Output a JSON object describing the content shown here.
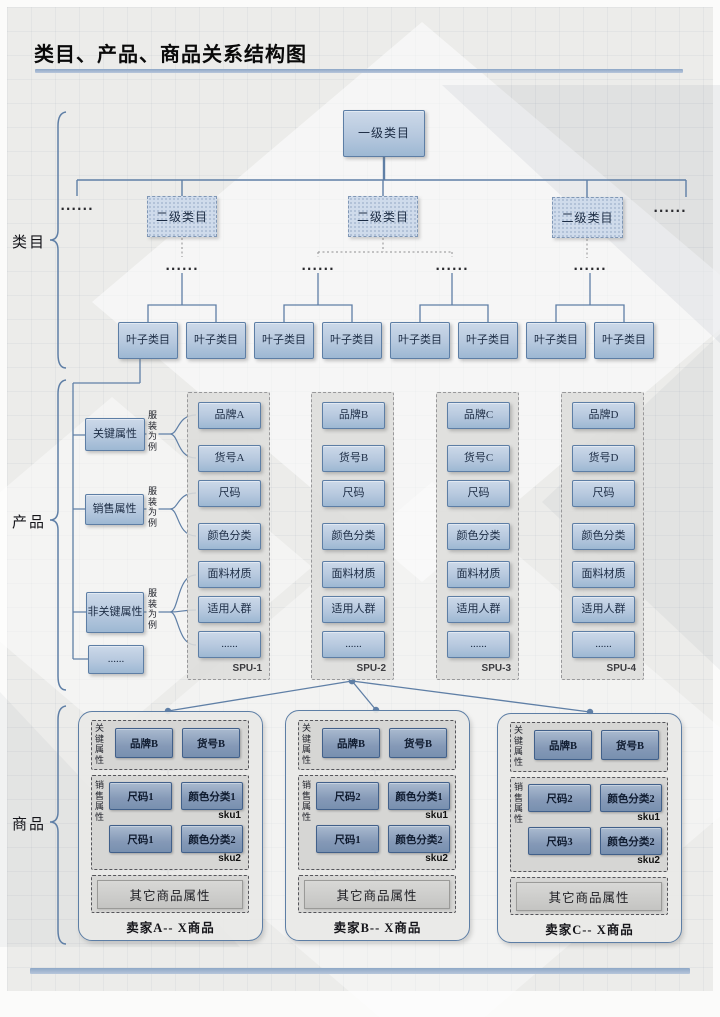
{
  "title": "类目、产品、商品关系结构图",
  "dots": "......",
  "sections": {
    "category": "类目",
    "product": "产品",
    "commodity": "商品"
  },
  "category": {
    "level1": "一级类目",
    "level2": "二级类目",
    "leaf": "叶子类目"
  },
  "product": {
    "attr_key": "关键属性",
    "attr_sales": "销售属性",
    "attr_nonkey": "非关键属性",
    "attr_more": "......",
    "example_note": "服装为例",
    "spus": [
      {
        "name": "SPU-1",
        "items": [
          "品牌A",
          "货号A",
          "尺码",
          "颜色分类",
          "面料材质",
          "适用人群",
          "......"
        ]
      },
      {
        "name": "SPU-2",
        "items": [
          "品牌B",
          "货号B",
          "尺码",
          "颜色分类",
          "面料材质",
          "适用人群",
          "......"
        ]
      },
      {
        "name": "SPU-3",
        "items": [
          "品牌C",
          "货号C",
          "尺码",
          "颜色分类",
          "面料材质",
          "适用人群",
          "......"
        ]
      },
      {
        "name": "SPU-4",
        "items": [
          "品牌D",
          "货号D",
          "尺码",
          "颜色分类",
          "面料材质",
          "适用人群",
          "......"
        ]
      }
    ]
  },
  "commodity": {
    "key_label": "关键属性",
    "sales_label": "销售属性",
    "sellers": [
      {
        "name": "卖家A-- X商品",
        "brand": "品牌B",
        "article": "货号B",
        "other": "其它商品属性",
        "skus": [
          {
            "size": "尺码1",
            "color": "颜色分类1",
            "tag": "sku1"
          },
          {
            "size": "尺码1",
            "color": "颜色分类2",
            "tag": "sku2"
          }
        ]
      },
      {
        "name": "卖家B-- X商品",
        "brand": "品牌B",
        "article": "货号B",
        "other": "其它商品属性",
        "skus": [
          {
            "size": "尺码2",
            "color": "颜色分类1",
            "tag": "sku1"
          },
          {
            "size": "尺码1",
            "color": "颜色分类2",
            "tag": "sku2"
          }
        ]
      },
      {
        "name": "卖家C-- X商品",
        "brand": "品牌B",
        "article": "货号B",
        "other": "其它商品属性",
        "skus": [
          {
            "size": "尺码2",
            "color": "颜色分类2",
            "tag": "sku1"
          },
          {
            "size": "尺码3",
            "color": "颜色分类2",
            "tag": "sku2"
          }
        ]
      }
    ]
  }
}
